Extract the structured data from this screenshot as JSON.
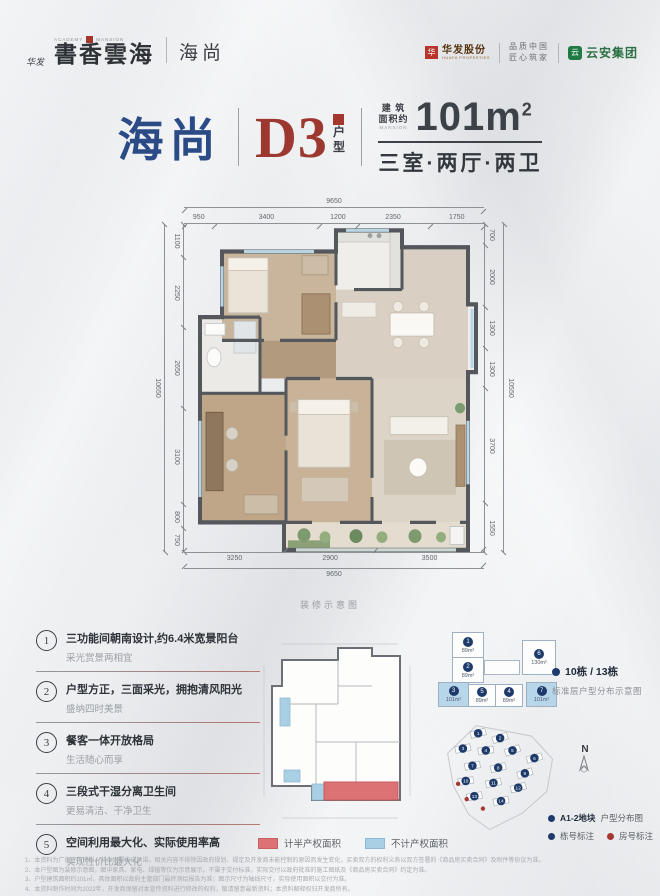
{
  "brand": {
    "huafa_small": "华发",
    "academy": "ACADEMY",
    "mansion": "MANSION",
    "calligraphy": "書香雲海",
    "series": "海尚",
    "huafa_group": "华发股份",
    "huafa_group_sub": "HUAFA PROPERTIES",
    "slogan1": "品质中国",
    "slogan2": "匠心筑家",
    "partner": "云安集团",
    "hf_glyph": "华",
    "ya_glyph": "云"
  },
  "title": {
    "name": "海尚",
    "unit": "D3",
    "unit_type_1": "户",
    "unit_type_2": "型",
    "area_prefix_1": "建 筑",
    "area_prefix_2": "面积约",
    "area_prefix_3": "MANSION",
    "area_value": "101m",
    "area_sup": "2",
    "rooms": "三室·两厅·两卫"
  },
  "plan": {
    "caption": "装修示意图",
    "dims": {
      "top_total": "9650",
      "top": [
        "950",
        "3400",
        "1200",
        "2350",
        "1750"
      ],
      "left_total": "10650",
      "left": [
        "1100",
        "2250",
        "2650",
        "3100",
        "800",
        "750"
      ],
      "right_total": "10550",
      "right": [
        "700",
        "2000",
        "1300",
        "1300",
        "3700",
        "1550"
      ],
      "bottom": [
        "3250",
        "2900",
        "3500"
      ],
      "bottom_total": "9650"
    }
  },
  "features": [
    {
      "num": "1",
      "title": "三功能间朝南设计,约6.4米宽景阳台",
      "desc": "采光赏景两相宜"
    },
    {
      "num": "2",
      "title": "户型方正，三面采光，拥抱清风阳光",
      "desc": "盛纳四时美景"
    },
    {
      "num": "3",
      "title": "餐客一体开放格局",
      "desc": "生活随心而享"
    },
    {
      "num": "4",
      "title": "三段式干湿分离卫生间",
      "desc": "更易清洁、干净卫生"
    },
    {
      "num": "5",
      "title": "空间利用最大化、实际使用率高",
      "desc": "实现性价比最大化"
    }
  ],
  "mini_legend": {
    "red": "计半产权面积",
    "blue": "不计产权面积"
  },
  "floorplate": {
    "units": [
      {
        "no": "1",
        "area": "89m²"
      },
      {
        "no": "2",
        "area": "89m²"
      },
      {
        "no": "6",
        "area": "130m²"
      },
      {
        "no": "3",
        "area": "101m²"
      },
      {
        "no": "5",
        "area": "89m²"
      },
      {
        "no": "4",
        "area": "89m²"
      },
      {
        "no": "7",
        "area": "101m²"
      }
    ],
    "title": "10栋 / 13栋",
    "subtitle": "标准层户型分布示意图"
  },
  "siteplan": {
    "north_label": "N",
    "buildings": [
      "1",
      "2",
      "3",
      "4",
      "5",
      "6",
      "7",
      "8",
      "9",
      "10",
      "11",
      "12",
      "13",
      "14"
    ],
    "legend_title_bold": "A1-2地块",
    "legend_title_rest": "户型分布图",
    "legend_building": "栋号标注",
    "legend_room": "房号标注"
  },
  "disclaimer": [
    "1、本资料为广告宣传资料，非合同要约或承诺，相关内容不排除因政府规划、规定及开发商未能控制的原因而发生变化，买卖双方的权利义务以双方签署的《商品房买卖合同》及附件等协议为准。",
    "2、本户型图为装修示意图，图中家具、家电、绿植等仅为示意展示，不属于交付标准，实际交付以政府批准的施工图纸及《商品房买卖合同》约定为准。",
    "3、户型建筑面积约101㎡，具体面积以政府主管部门最终测绘报告为准；图示尺寸为轴线尺寸，实际使用面积以交付为准。",
    "4、本资料制作时间为2022年，开发商保留对本宣传资料进行修改的权利，敬请留意最新资料；本资料解释权归开发商所有。"
  ]
}
